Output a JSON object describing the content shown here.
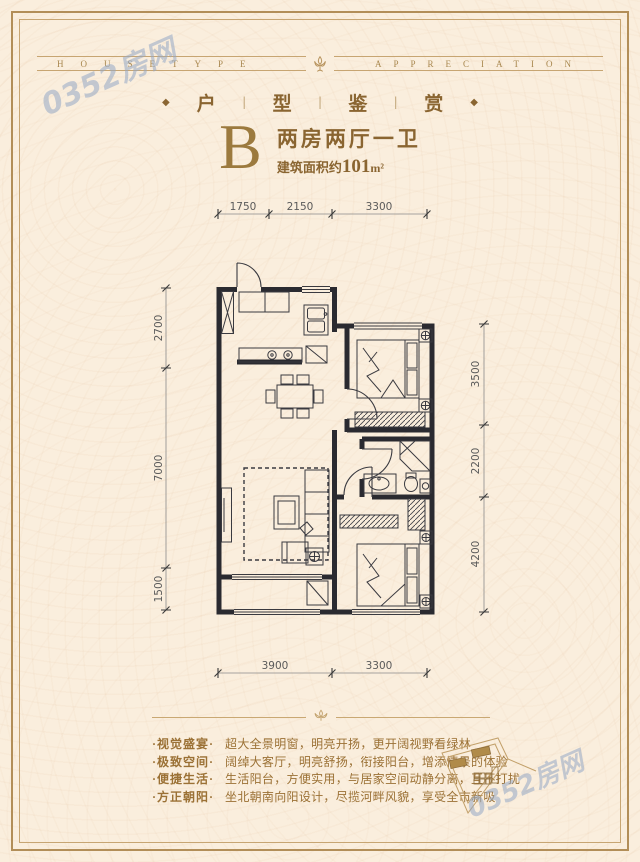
{
  "theme": {
    "bg": "#faeedd",
    "frame_gold": "#b28e58",
    "inner_gold": "#c7a572",
    "caption_gold": "#a8874e",
    "title_gold": "#9c7a3e",
    "text_brown": "#8a6531",
    "feature_brown": "#9b7135",
    "wall_color": "#2a2a30",
    "dim_color": "#5a5a5a",
    "watermark_blue": "#93a8c5"
  },
  "header": {
    "left_caption": "HOUSETYPE",
    "right_caption": "APPRECIATION",
    "title_chars": [
      "户",
      "型",
      "鉴",
      "赏"
    ],
    "separator": "|",
    "diamond": "◆"
  },
  "unit": {
    "letter": "B",
    "layout": "两房两厅一卫",
    "area_prefix": "建筑面积约",
    "area_value": "101",
    "area_unit": "m²"
  },
  "plan": {
    "dims_top": [
      "1750",
      "2150",
      "3300"
    ],
    "dims_bottom": [
      "3900",
      "3300"
    ],
    "dims_left": [
      "2700",
      "7000",
      "1500"
    ],
    "dims_right": [
      "3500",
      "2200",
      "4200"
    ]
  },
  "features": [
    {
      "tag": "·视觉盛宴·",
      "desc": "超大全景明窗，明亮开扬，更开阔视野看绿林"
    },
    {
      "tag": "·极致空间·",
      "desc": "阔绰大客厅，明亮舒扬，衔接阳台，增添情景的体验"
    },
    {
      "tag": "·便捷生活·",
      "desc": "生活阳台，方便实用，与居家空间动静分离，互不打扰"
    },
    {
      "tag": "·方正朝阳·",
      "desc": "坐北朝南向阳设计，尽揽河畔风貌，享受全市新吸"
    }
  ],
  "watermark": {
    "text": "0352房网"
  }
}
